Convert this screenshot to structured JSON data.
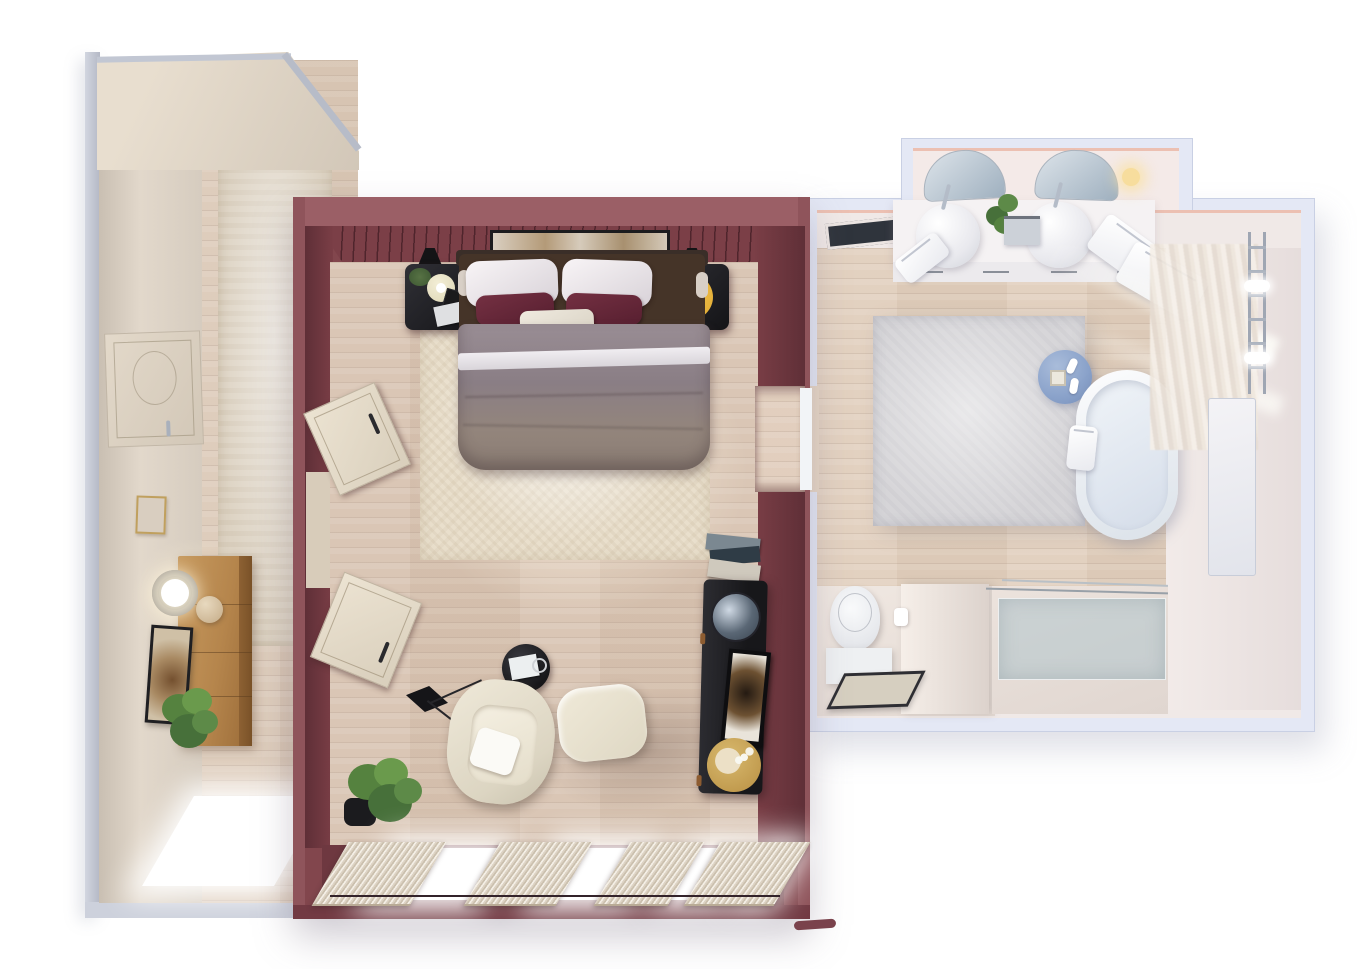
{
  "scene": {
    "title": "Top-down 3D interior render — bedroom suite floor plan",
    "style": "photoreal top-down architectural visualization, no on-screen text",
    "rooms": [
      {
        "name": "hallway",
        "wall_color": "#ddd3c6",
        "items": [
          "entry-door",
          "runner-rug",
          "wood-sideboard",
          "table-lamp",
          "decor-sphere",
          "leaning-artwork",
          "potted-plant",
          "small-wall-frame",
          "window"
        ]
      },
      {
        "name": "bedroom",
        "wall_color": "#82464d",
        "items": [
          "double-bed",
          "headboard",
          "white-pillows",
          "burgundy-pillows",
          "lumbar-pillow",
          "gray-duvet",
          "nightstand-left",
          "nightstand-right",
          "wall-lamp-left",
          "wall-lamp-right",
          "wall-artwork",
          "area-rug",
          "open-door-upper",
          "open-door-lower",
          "armchair",
          "ottoman",
          "round-side-table",
          "floor-lamp",
          "potted-plant",
          "console-cabinet",
          "round-mirror",
          "console-artwork",
          "gold-tray",
          "book-stack",
          "curtain-panels",
          "window-wall",
          "doorway-to-bathroom"
        ]
      },
      {
        "name": "bathroom",
        "wall_color": "#e4e8f5",
        "items": [
          "double-vanity",
          "vessel-sink-left",
          "vessel-sink-right",
          "mirror-left",
          "mirror-right",
          "vanity-plant",
          "wall-sconce",
          "towels",
          "ceiling-vent",
          "area-rug",
          "blue-stool",
          "freestanding-bathtub",
          "tub-towel",
          "sheer-curtain",
          "towel-ladder",
          "wall-panel",
          "wall-hung-toilet",
          "toilet-shelf",
          "bath-mat",
          "partition-wall",
          "walk-in-shower",
          "shower-glass"
        ]
      }
    ],
    "palette": {
      "background": "#ffffff",
      "bedroom_wall": "#82464d",
      "bedroom_wall_light": "#9b5f66",
      "bedroom_wall_dark": "#5f2f37",
      "wood_floor": "#d8c3b1",
      "hall_wall_beige": "#ddd3c6",
      "bath_wall_lavender": "#e4e8f5",
      "bath_trim_pink": "#ecc0b2",
      "bath_interior": "#f0e9e7",
      "duvet_gray": "#8d8188",
      "accent_pillow": "#682a3c",
      "nightstand_black": "#1f1f23",
      "tray_yellow": "#eab93e",
      "stool_blue": "#8aa2ca",
      "sideboard_oak": "#b5854c",
      "plant_green": "#55823f",
      "rug_cream": "#e9dfcc",
      "rug_gray": "#d6d5d8",
      "glass_blue": "#b0c4cc"
    }
  }
}
